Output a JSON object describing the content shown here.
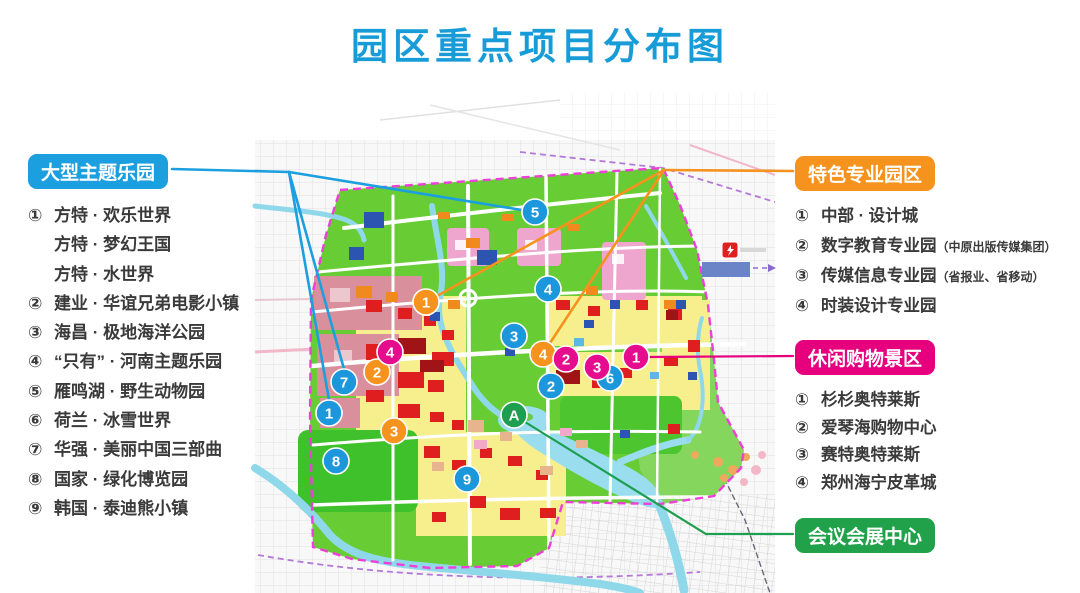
{
  "title": "园区重点项目分布图",
  "title_color": "#189CD8",
  "sections": {
    "theme_parks": {
      "label": "大型主题乐园",
      "accent": "#1C9FDE",
      "items": [
        {
          "num": "①",
          "text": "方特 · 欢乐世界",
          "sub": ""
        },
        {
          "num": "",
          "text": "方特 · 梦幻王国",
          "sub": ""
        },
        {
          "num": "",
          "text": "方特 · 水世界",
          "sub": ""
        },
        {
          "num": "②",
          "text": "建业 · 华谊兄弟电影小镇",
          "sub": ""
        },
        {
          "num": "③",
          "text": "海昌 · 极地海洋公园",
          "sub": ""
        },
        {
          "num": "④",
          "text": "“只有” · 河南主题乐园",
          "sub": ""
        },
        {
          "num": "⑤",
          "text": "雁鸣湖 · 野生动物园",
          "sub": ""
        },
        {
          "num": "⑥",
          "text": "荷兰 · 冰雪世界",
          "sub": ""
        },
        {
          "num": "⑦",
          "text": "华强 · 美丽中国三部曲",
          "sub": ""
        },
        {
          "num": "⑧",
          "text": "国家 · 绿化博览园",
          "sub": ""
        },
        {
          "num": "⑨",
          "text": "韩国 · 泰迪熊小镇",
          "sub": ""
        }
      ]
    },
    "special_parks": {
      "label": "特色专业园区",
      "accent": "#F6921E",
      "items": [
        {
          "num": "①",
          "text": "中部 · 设计城",
          "sub": ""
        },
        {
          "num": "②",
          "text": "数字教育专业园",
          "sub": "（中原出版传媒集团）"
        },
        {
          "num": "③",
          "text": "传媒信息专业园",
          "sub": "（省报业、省移动）"
        },
        {
          "num": "④",
          "text": "时装设计专业园",
          "sub": ""
        }
      ]
    },
    "shopping": {
      "label": "休闲购物景区",
      "accent": "#E6007E",
      "items": [
        {
          "num": "①",
          "text": "杉杉奥特莱斯",
          "sub": ""
        },
        {
          "num": "②",
          "text": "爱琴海购物中心",
          "sub": ""
        },
        {
          "num": "③",
          "text": "赛特奥特莱斯",
          "sub": ""
        },
        {
          "num": "④",
          "text": "郑州海宁皮革城",
          "sub": ""
        }
      ]
    },
    "convention": {
      "label": "会议会展中心",
      "accent": "#22A14B"
    }
  },
  "map": {
    "boundary_color": "#EE3FD8",
    "park_green": "#68CD34",
    "marker_colors": {
      "theme_parks": "#1C97DC",
      "special_parks": "#F6921E",
      "shopping": "#E50C8E",
      "convention": "#1E9E50"
    },
    "markers": [
      {
        "label": "5",
        "group": "theme_parks",
        "x": 535,
        "y": 212
      },
      {
        "label": "4",
        "group": "theme_parks",
        "x": 548,
        "y": 289
      },
      {
        "label": "3",
        "group": "theme_parks",
        "x": 514,
        "y": 336
      },
      {
        "label": "7",
        "group": "theme_parks",
        "x": 344,
        "y": 382
      },
      {
        "label": "1",
        "group": "theme_parks",
        "x": 329,
        "y": 413
      },
      {
        "label": "8",
        "group": "theme_parks",
        "x": 336,
        "y": 461
      },
      {
        "label": "9",
        "group": "theme_parks",
        "x": 467,
        "y": 479
      },
      {
        "label": "2",
        "group": "theme_parks",
        "x": 551,
        "y": 386
      },
      {
        "label": "6",
        "group": "theme_parks",
        "x": 610,
        "y": 378
      },
      {
        "label": "1",
        "group": "special_parks",
        "x": 426,
        "y": 302
      },
      {
        "label": "2",
        "group": "special_parks",
        "x": 377,
        "y": 372
      },
      {
        "label": "3",
        "group": "special_parks",
        "x": 394,
        "y": 431
      },
      {
        "label": "4",
        "group": "special_parks",
        "x": 543,
        "y": 354
      },
      {
        "label": "4",
        "group": "shopping",
        "x": 390,
        "y": 352
      },
      {
        "label": "2",
        "group": "shopping",
        "x": 566,
        "y": 359
      },
      {
        "label": "3",
        "group": "shopping",
        "x": 597,
        "y": 367
      },
      {
        "label": "1",
        "group": "shopping",
        "x": 636,
        "y": 357
      },
      {
        "label": "A",
        "group": "convention",
        "x": 514,
        "y": 415
      }
    ]
  }
}
